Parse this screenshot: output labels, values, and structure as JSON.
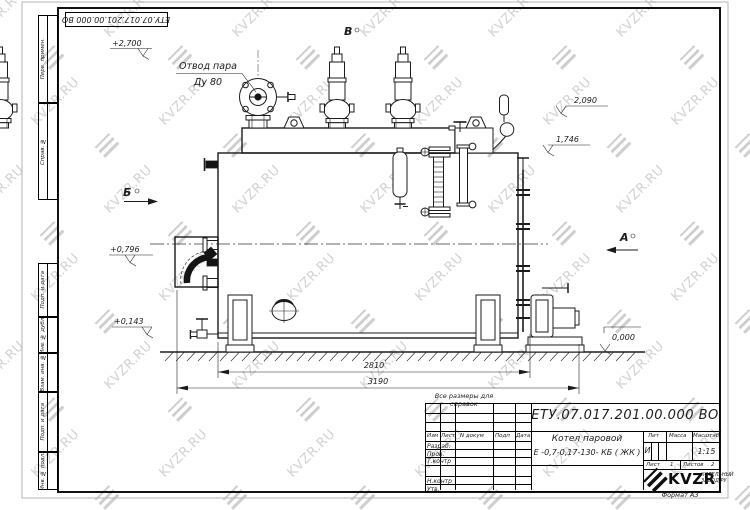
{
  "sheet": {
    "stamp": "ЕТУ.07.017.201.00.000  ВО",
    "reference_note": "Все размеры для справок",
    "format_note": "Формат А3"
  },
  "margin": {
    "labels": [
      "Перв. примен.",
      "Справ. №",
      "Подп. и дата",
      "Инв. № дубл.",
      "Взам. инв. №",
      "Подп. и дата",
      "Инв. № подл."
    ]
  },
  "watermark": {
    "text": "KVZR.RU",
    "color": "#c6c6c6"
  },
  "drawing": {
    "callout_line1": "Отвод пара",
    "callout_line2": "Ду 80",
    "views": {
      "a": "А",
      "b": "Б",
      "v": "В"
    },
    "elevations": {
      "plus2700": "+2,700",
      "e2090": "2,090",
      "e1746": "1,746",
      "plus0796": "+0,796",
      "plus0143": "+0,143",
      "zero": "0,000"
    },
    "dims": {
      "d2810": "2810",
      "d3190": "3190"
    }
  },
  "title_block": {
    "doc_number": "ЕТУ.07.017.201.00.000  ВО",
    "product_line1": "Котел паровой",
    "product_line2": "Е -0,7-0,17-130- КБ ( ЖК )",
    "cols": {
      "izm": "Изм",
      "list": "Лист",
      "ndocum": "N докум",
      "podp": "Подп",
      "data": "Дата"
    },
    "rows": {
      "razrab": "Разраб.",
      "prov": "Пров.",
      "tkontr": "Т.контр",
      "nkontr": "Н.контр",
      "utv": "Утв."
    },
    "lit_label": "Лит",
    "mass_label": "Масса",
    "scale_label": "Масштаб",
    "lit_value": "И",
    "scale_value": "1:15",
    "sheet_label": "Лист",
    "sheet_value": "1",
    "sheets_label": "Листов",
    "sheets_value": "2",
    "logo": {
      "name": "KVZR",
      "sub1": "КОТЕЛЬНЫЙ",
      "sub2": "ЗАВОД РУ"
    }
  }
}
